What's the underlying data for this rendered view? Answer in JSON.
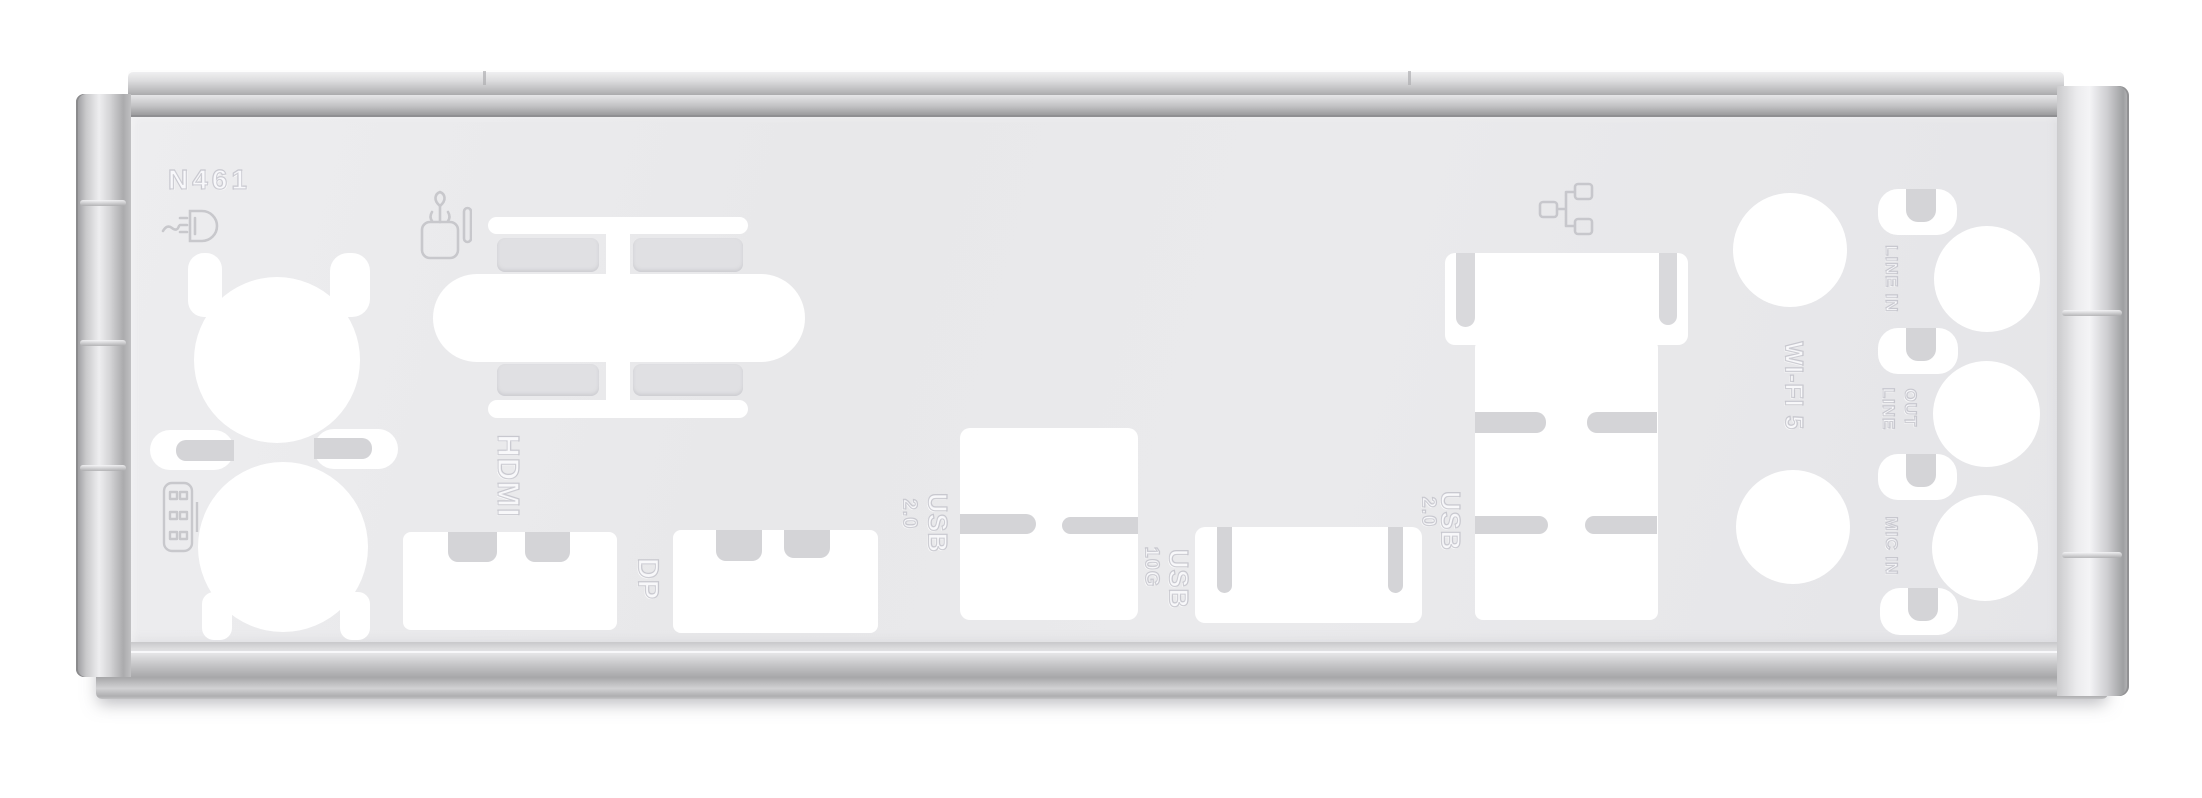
{
  "photo": {
    "subject": "Motherboard rear I/O shield backplate, brushed metal, punched port cutouts",
    "part_number": "N461",
    "embossed": {
      "part_number": "N461",
      "hdmi": "HDMI",
      "dp": "DP",
      "usb2_left": {
        "label": "USB 2.0",
        "word": "USB",
        "version": "2.0"
      },
      "usb_10g": {
        "label": "USB 10G",
        "word": "USB",
        "version": "10G"
      },
      "usb2_right": {
        "label": "USB 2.0",
        "word": "USB",
        "version": "2.0"
      },
      "wifi": "WI-FI 5",
      "line_in": "LINE IN",
      "line_out": {
        "label": "LINE OUT",
        "word1": "LINE",
        "word2": "OUT"
      },
      "mic_in": "MIC IN"
    },
    "icons": [
      {
        "name": "dvi-port-icon",
        "meaning": "DVI / D-sub display connector glyph"
      },
      {
        "name": "spdif-optical-icon",
        "meaning": "S/PDIF optical out glyph"
      },
      {
        "name": "ethernet-lan-icon",
        "meaning": "RJ-45 LAN network glyph"
      },
      {
        "name": "pin-header-icon",
        "meaning": "connector pin-block glyph"
      }
    ],
    "cutouts": [
      "round-port-hole-upper-left",
      "round-port-hole-lower-left",
      "legacy-capsule-knockout",
      "hdmi-port",
      "displayport-port",
      "usb2-port",
      "usb-10g-port",
      "lan-usb-tower",
      "wifi-antenna-hole-top",
      "wifi-antenna-hole-bottom",
      "audio-jack-line-in",
      "audio-jack-line-out",
      "audio-jack-mic-in",
      "spring-tab-slots"
    ],
    "colors": {
      "background": "#ffffff",
      "plate_face": "#e8e8ea",
      "cutout_white": "#ffffff",
      "flange_highlight": "#f2f2f4",
      "flange_shadow": "#9b9b9d",
      "emboss_line": "#c2c2c6",
      "bent_tab": "#d4d4d7"
    }
  }
}
